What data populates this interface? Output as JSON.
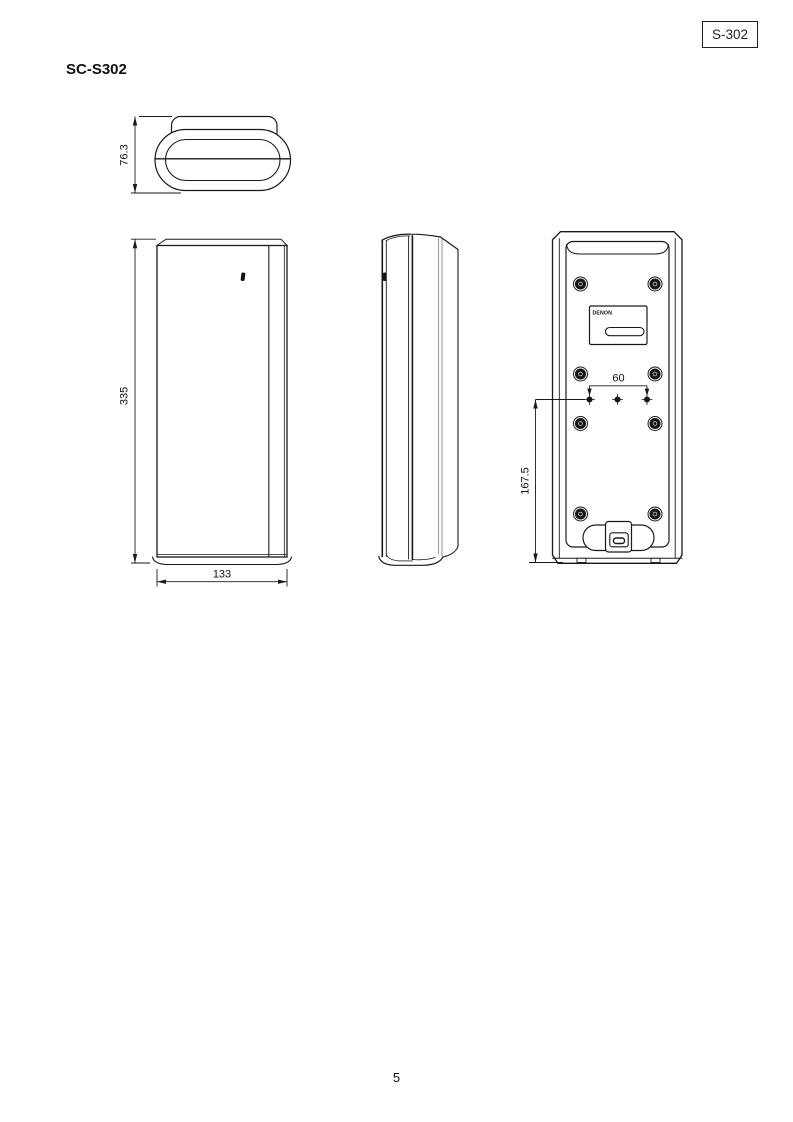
{
  "badge": {
    "label": "S-302"
  },
  "title": "SC-S302",
  "footer": {
    "page_number": "5"
  },
  "drawing": {
    "brand_label": "DENON",
    "dimensions": {
      "top_depth": "76.3",
      "front_height": "335",
      "front_width": "133",
      "mount_spacing": "60",
      "mount_height": "167.5"
    }
  }
}
